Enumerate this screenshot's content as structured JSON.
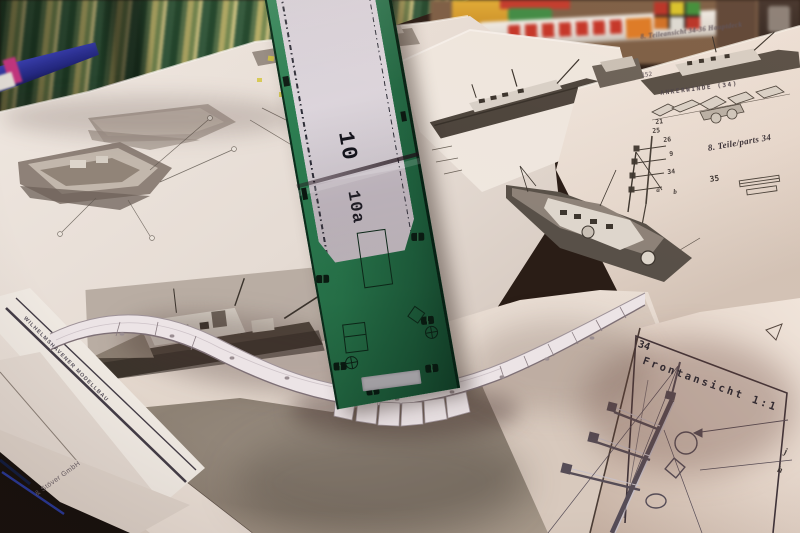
{
  "green_part": {
    "number_top": "10",
    "number_bottom": "10a"
  },
  "right_page": {
    "heading": "8. Teileansicht 34-36 Hauptdeck",
    "figure_number": "152",
    "winch_label": "ANKERWINDE (34)",
    "parts_caption": "8. Teile/parts 34",
    "callouts": [
      "21",
      "25",
      "26",
      "9",
      "34",
      "a",
      "b",
      "35"
    ]
  },
  "frontansicht_sheet": {
    "panel_number": "34",
    "panel_title": "Frontansicht 1:1",
    "label_j": "j",
    "label_h": "h"
  },
  "page_edges": {
    "vertical_text": "WILHELMSHAVENER MODELLBAU",
    "publisher": "& Stöver GmbH"
  },
  "colors": {
    "card_green": "#2a7a4e",
    "card_green_dark": "#16492e",
    "label_lavender": "#d6cfd8",
    "paper_warm": "#eae1da",
    "paper_shadow": "#c7b6ab",
    "print_gray": "#95897d",
    "fabric_green": "#3f6b45",
    "fabric_yellow": "#b8b166",
    "box_yellow": "#d9a333",
    "tube_red": "#c43427",
    "pen_blue": "#2c2f93",
    "pen_magenta": "#c2357c"
  }
}
